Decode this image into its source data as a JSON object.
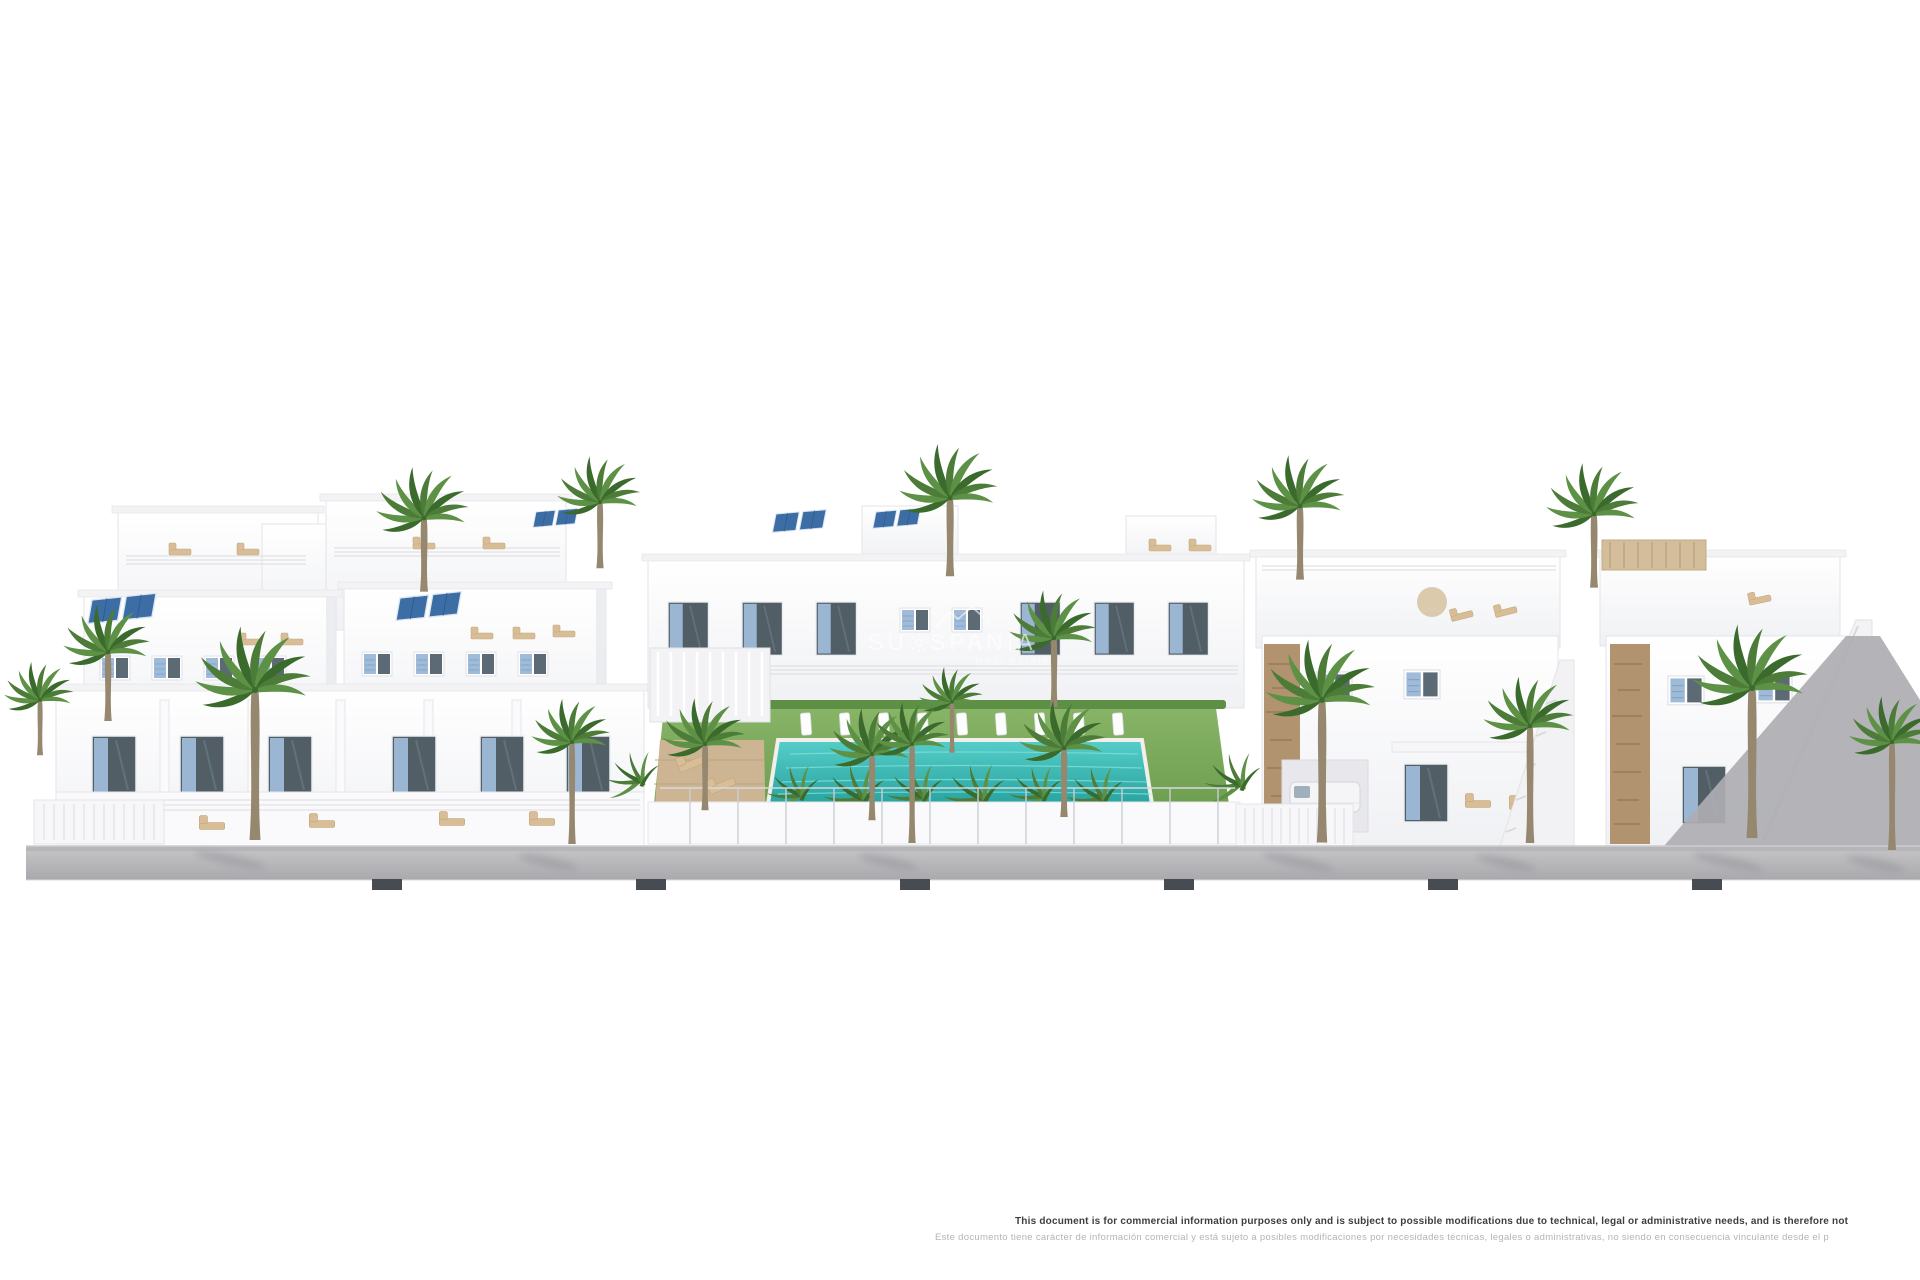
{
  "image": {
    "alt": "3D architectural render of a white Mediterranean residential complex: terraced apartments with blue shutters and rooftop solar panels on the left, a communal garden with lawn, palm trees and a turquoise pool in the centre, white villas with stone accents and external stairs on the right, all along a grey sidewalk with palm trees"
  },
  "watermark": {
    "brand_prefix": "SU",
    "brand_suffix": "SPANIA",
    "sun_icon": "sun-rays",
    "roof_icon": "roofline",
    "tagline": "Real Estate"
  },
  "disclaimer": {
    "line_en": "This document is for commercial information purposes only and is subject to possible modifications due to technical, legal or administrative needs, and is therefore not",
    "line_es": "Este documento tiene carácter de información comercial y está sujeto a posibles modificaciones por necesidades técnicas, legales o administrativas, no siendo en consecuencia vinculante desde el p"
  },
  "colors": {
    "shutter-blue": "#9fbbd8",
    "solar-blue": "#3c6ea5",
    "pool-turquoise": "#3bbdb8",
    "lawn-green": "#74a455",
    "street-gray": "#b6b6b8",
    "curb-dark": "#474c52",
    "palm-green": "#4c7c38",
    "trunk-brown": "#96876f",
    "stone-tan": "#b1946f",
    "lounger-tan": "#d9bd97",
    "disclaimer-dark": "#3e3e3e",
    "disclaimer-light": "#b4b4b4"
  }
}
